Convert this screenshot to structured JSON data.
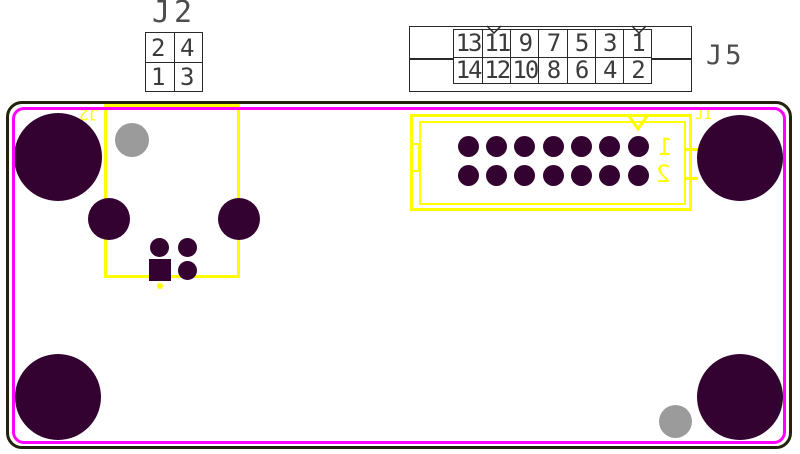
{
  "title": "PCB bottom-side assembly view with connectors J2 and J5",
  "colors": {
    "pad": "#340230",
    "hole": "#9b9b9b",
    "silkscreen": "#ffff00",
    "courtyard": "#ff00ff",
    "board_outline": "#23230d",
    "table_line": "#2a2a2a",
    "table_text": "#3b3b3b",
    "label_text": "#4d4d4d"
  },
  "j2_header": {
    "label": "J2",
    "grid": [
      [
        "2",
        "4"
      ],
      [
        "1",
        "3"
      ]
    ]
  },
  "j5_header": {
    "label": "J5",
    "grid": [
      [
        "13",
        "11",
        "9",
        "7",
        "5",
        "3",
        "1"
      ],
      [
        "14",
        "12",
        "10",
        "8",
        "6",
        "4",
        "2"
      ]
    ]
  },
  "board": {
    "silkscreen": {
      "j2_ref": "J2",
      "j5_ref": "J1",
      "pin_row1_label": "1",
      "pin_row2_label": "2"
    },
    "j5_pad_grid": {
      "cols": [
        468,
        496.3,
        524.7,
        553,
        581.3,
        609.7,
        638
      ],
      "rows": [
        146,
        175
      ],
      "r": 10.5,
      "color": "pad",
      "name": "j5-pad"
    },
    "pads": [
      {
        "name": "mounting-hole-top-left",
        "shape": "circle",
        "x": 58,
        "y": 157,
        "r": 44,
        "color": "pad"
      },
      {
        "name": "mounting-hole-top-right",
        "shape": "circle",
        "x": 740,
        "y": 158,
        "r": 43,
        "color": "pad"
      },
      {
        "name": "mounting-hole-bottom-left",
        "shape": "circle",
        "x": 58,
        "y": 397,
        "r": 43,
        "color": "pad"
      },
      {
        "name": "mounting-hole-bottom-right",
        "shape": "circle",
        "x": 740,
        "y": 397,
        "r": 43,
        "color": "pad"
      },
      {
        "name": "unplated-hole-top-left",
        "shape": "circle",
        "x": 132,
        "y": 140,
        "r": 17,
        "color": "hole"
      },
      {
        "name": "unplated-hole-bottom-right",
        "shape": "circle",
        "x": 675,
        "y": 421,
        "r": 16.5,
        "color": "hole"
      },
      {
        "name": "j2-mount-hole-left",
        "shape": "circle",
        "x": 109,
        "y": 219,
        "r": 21,
        "color": "pad"
      },
      {
        "name": "j2-mount-hole-right",
        "shape": "circle",
        "x": 239,
        "y": 219,
        "r": 21,
        "color": "pad"
      },
      {
        "name": "j2-pad-2",
        "shape": "circle",
        "x": 159,
        "y": 247,
        "r": 9.5,
        "color": "pad"
      },
      {
        "name": "j2-pad-4",
        "shape": "circle",
        "x": 187,
        "y": 247,
        "r": 9.5,
        "color": "pad"
      },
      {
        "name": "j2-pad-3",
        "shape": "circle",
        "x": 187,
        "y": 270,
        "r": 9.5,
        "color": "pad"
      },
      {
        "name": "j2-pad-1",
        "shape": "square",
        "x": 159.5,
        "y": 270,
        "r": 11,
        "color": "pad"
      },
      {
        "name": "silk-dot",
        "shape": "circle",
        "x": 159.5,
        "y": 285.5,
        "r": 3,
        "color": "silkscreen"
      }
    ]
  }
}
